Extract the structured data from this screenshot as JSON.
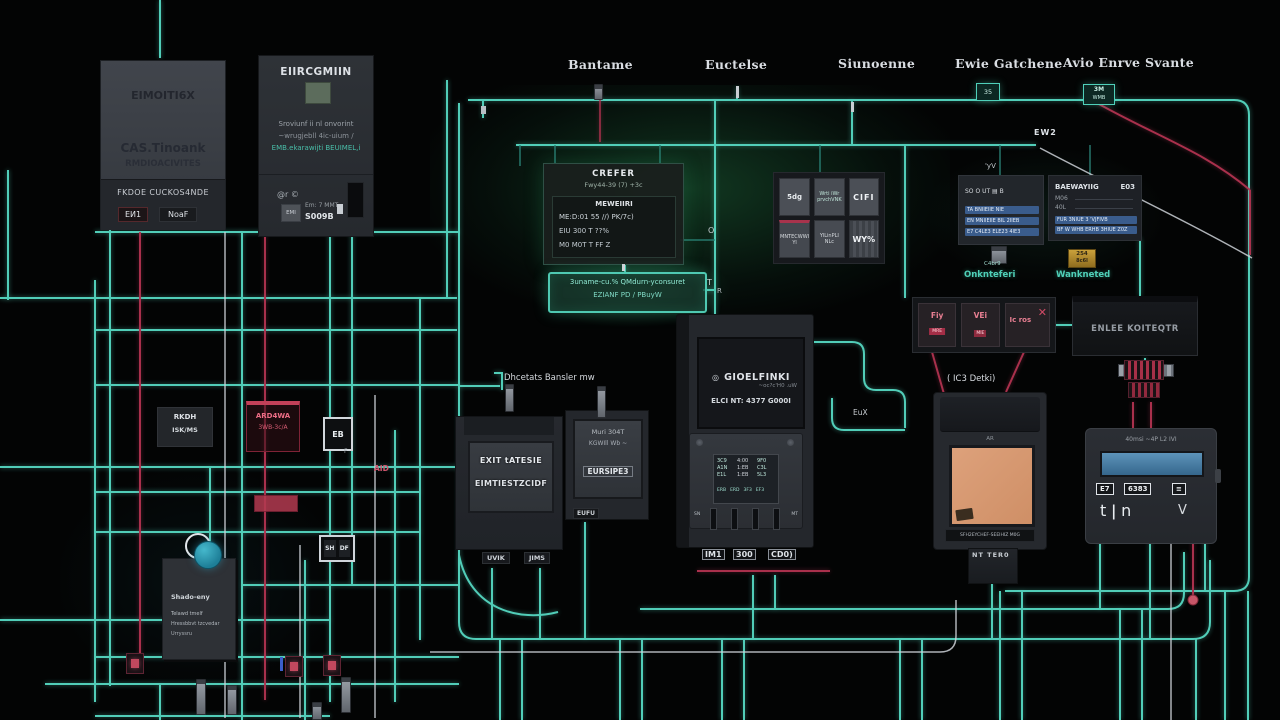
{
  "top_labels": [
    "Bantame",
    "Euctelse",
    "Siunoenne",
    "Ewie Gatchene",
    "Avio Enrve Svante"
  ],
  "finder_box": {
    "title": "EIMOITI6X",
    "line1": "CAS.Tinoank",
    "line2": "RMDIOACIVITES",
    "footer": "FKDOE CUCKOS4NDE",
    "tab1": "EИ1",
    "tab2": "NoaF"
  },
  "energy_box": {
    "title": "EIIRCGMIIN",
    "body1": "Sroviunf ii nl onvorint",
    "body2": "~wrugjebll 4ic-uium /",
    "body3": "EMB.ekarawijti BEUIMEL,i",
    "at_mark": "@r ©",
    "chip": "EMI",
    "em_line": "Em: 7 MMT",
    "code": "S009B"
  },
  "display_panel": {
    "title": "CREFER",
    "sub": "Fwy44-39 (7)   +3c",
    "header2": "MEWEIIRI",
    "row1": "ME:D:01 55 //)  PK/7c)",
    "row2": "EIU 300 T   ??%",
    "row3": "M0 M0T T   FF Z"
  },
  "status_bar": {
    "line1": "3uname-cu.% QMdurn-yconsuret",
    "line2": "EZIANF PD / PBuyW"
  },
  "grid_panel": {
    "cells": [
      "5dg",
      "Wrti iWr prvchVNK",
      "CIFI",
      "MNTECWWI Yl",
      "YlLinPLI NLc",
      "WY%"
    ]
  },
  "onk_panel": {
    "top_mark": "'yV",
    "row0": "SO O UT ▤ B",
    "rows": [
      "TA BNIIEIIE NIE",
      "EN MNIIEIIE BIL 2IIEB",
      "E7 C4LE3 ELE23 4IE3"
    ],
    "pin_mark": "C4br9",
    "label": "Onknteferi"
  },
  "wank_panel": {
    "title": "BAEWAYIIG",
    "title_right": "E03",
    "m1": "M06",
    "m2": "40L",
    "rows": [
      "FUR 3NIUE 3 'VJFIVB",
      "BF W WHB ERHB 3HIUE Z0Z"
    ],
    "chip_top": "254",
    "chip_bottom": "8c6l",
    "label": "Wankneted"
  },
  "relay_cells": {
    "c1": "Fiy",
    "c1_sub": "MRE",
    "c2": "VEi",
    "c2_sub": "MIE",
    "c3": "Ic ros",
    "c3_mark": "✕",
    "label": "( IC3 Detki)"
  },
  "encee_box": {
    "label": "ENLEE KOITEQTR"
  },
  "central_device": {
    "brand": "GIOELFINKI",
    "brand_icon": "◎",
    "sub": "~oc?c'H0 .uW",
    "model": "ELCI NT:  4377 G000I",
    "mini_a": [
      "3C9",
      "A1N",
      "E1L"
    ],
    "mini_b": [
      "4:00",
      "1:EB",
      "1:EB"
    ],
    "mini_c": [
      "9F0",
      "C3L",
      "5L3"
    ],
    "mini_foot": [
      "ERB",
      "ERD",
      "3F3",
      "EF3"
    ],
    "slot_left": "SN",
    "slot_right": "MT",
    "cap1": "IM1",
    "cap2": "300",
    "cap3": "CD0)"
  },
  "exit_device": {
    "line1": "EXIT tATESIE",
    "line2": "EIMTIESTZCIDF",
    "tab1": "UVIK",
    "tab2": "JIMS"
  },
  "eur_device": {
    "line1": "Muri 304T",
    "line2": "KGWIll Wb ~",
    "line3": "EURSIPE3",
    "tab": "EUFU"
  },
  "bansler_label": "Dhcetats  Bansler mw",
  "tan_device": {
    "top_mark": "AR",
    "caption": "SFH2EYCHEF-SEEIHIZ  M0G",
    "below_label": "NT TER0"
  },
  "meter_device": {
    "top_line": "40msi  ~4P  L2 IVI",
    "tok1": "E7",
    "tok2": "6383",
    "tok3": "≡",
    "glyphs": "t ǀ n",
    "glyph_v": "V"
  },
  "left_area": {
    "rkdh1": "RKDH",
    "rkdh2": "ISK/MS",
    "red1": "ARD4WA",
    "red2": "3WB-3c/A",
    "aid": "AID",
    "eb": "EB",
    "eb_f": "F",
    "sh": "SH",
    "df": "DF"
  },
  "shadow_box": {
    "title": "Shado-eny",
    "l1": "Telawd tmelf",
    "l2": "Hressbbvt tzcvedar",
    "l3": "Urryssru"
  },
  "wire_marks": {
    "wm1": "35",
    "wm2a": "3M",
    "wm2b": "WMB",
    "ew2": "EW2",
    "eux": "EuX",
    "o_mark": "O",
    "t_mark": "T",
    "r_mark": "R"
  },
  "colors": {
    "wire_teal": "#56d8c2",
    "wire_red": "#b23350",
    "wire_white": "#ccd1d7",
    "glow_green": "#1e7a4b",
    "screen_tan": "#d89b74",
    "lcd_blue": "#4e86ad",
    "row_blue": "#3a5c8c",
    "chip_orange": "#b98a2e",
    "dot_red": "#c75668"
  }
}
